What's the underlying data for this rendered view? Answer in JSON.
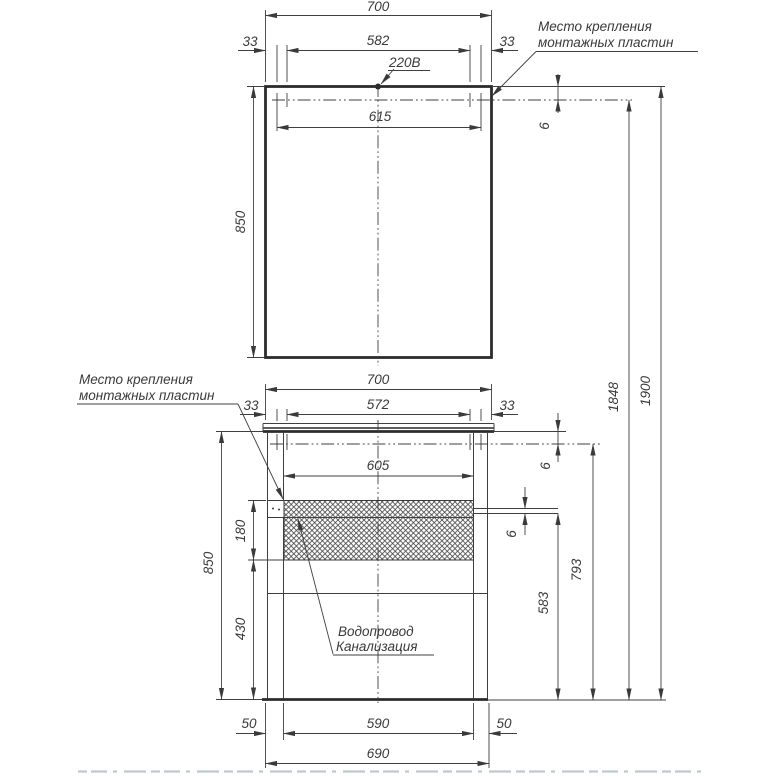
{
  "labels": {
    "power": "220В",
    "mount_top": {
      "line1": "Место крепления",
      "line2": "монтажных пластин"
    },
    "mount_left": {
      "line1": "Место крепления",
      "line2": "монтажных пластин"
    },
    "plumbing": {
      "line1": "Водопровод",
      "line2": "Канализация"
    }
  },
  "mirror": {
    "total_width": "700",
    "side_offset_left": "33",
    "plate_span": "582",
    "side_offset_right": "33",
    "hole_span": "615",
    "height": "850",
    "rail_inset": "6"
  },
  "cabinet": {
    "total_width": "700",
    "side_offset_left": "33",
    "plate_span": "572",
    "side_offset_right": "33",
    "hole_span": "605",
    "strip_height": "180",
    "height": "850",
    "lower_zone": "430",
    "top_inset": "6",
    "plate_thickness": "6",
    "plate_height": "583",
    "rail_height": "793"
  },
  "overall": {
    "rail_height": "1848",
    "total_height": "1900"
  },
  "base": {
    "foot_offset_left": "50",
    "foot_span": "590",
    "foot_offset_right": "50",
    "width": "690"
  },
  "colors": {
    "line": "#3a3a3a",
    "background": "#ffffff",
    "artifact": "#bcc9ce"
  }
}
